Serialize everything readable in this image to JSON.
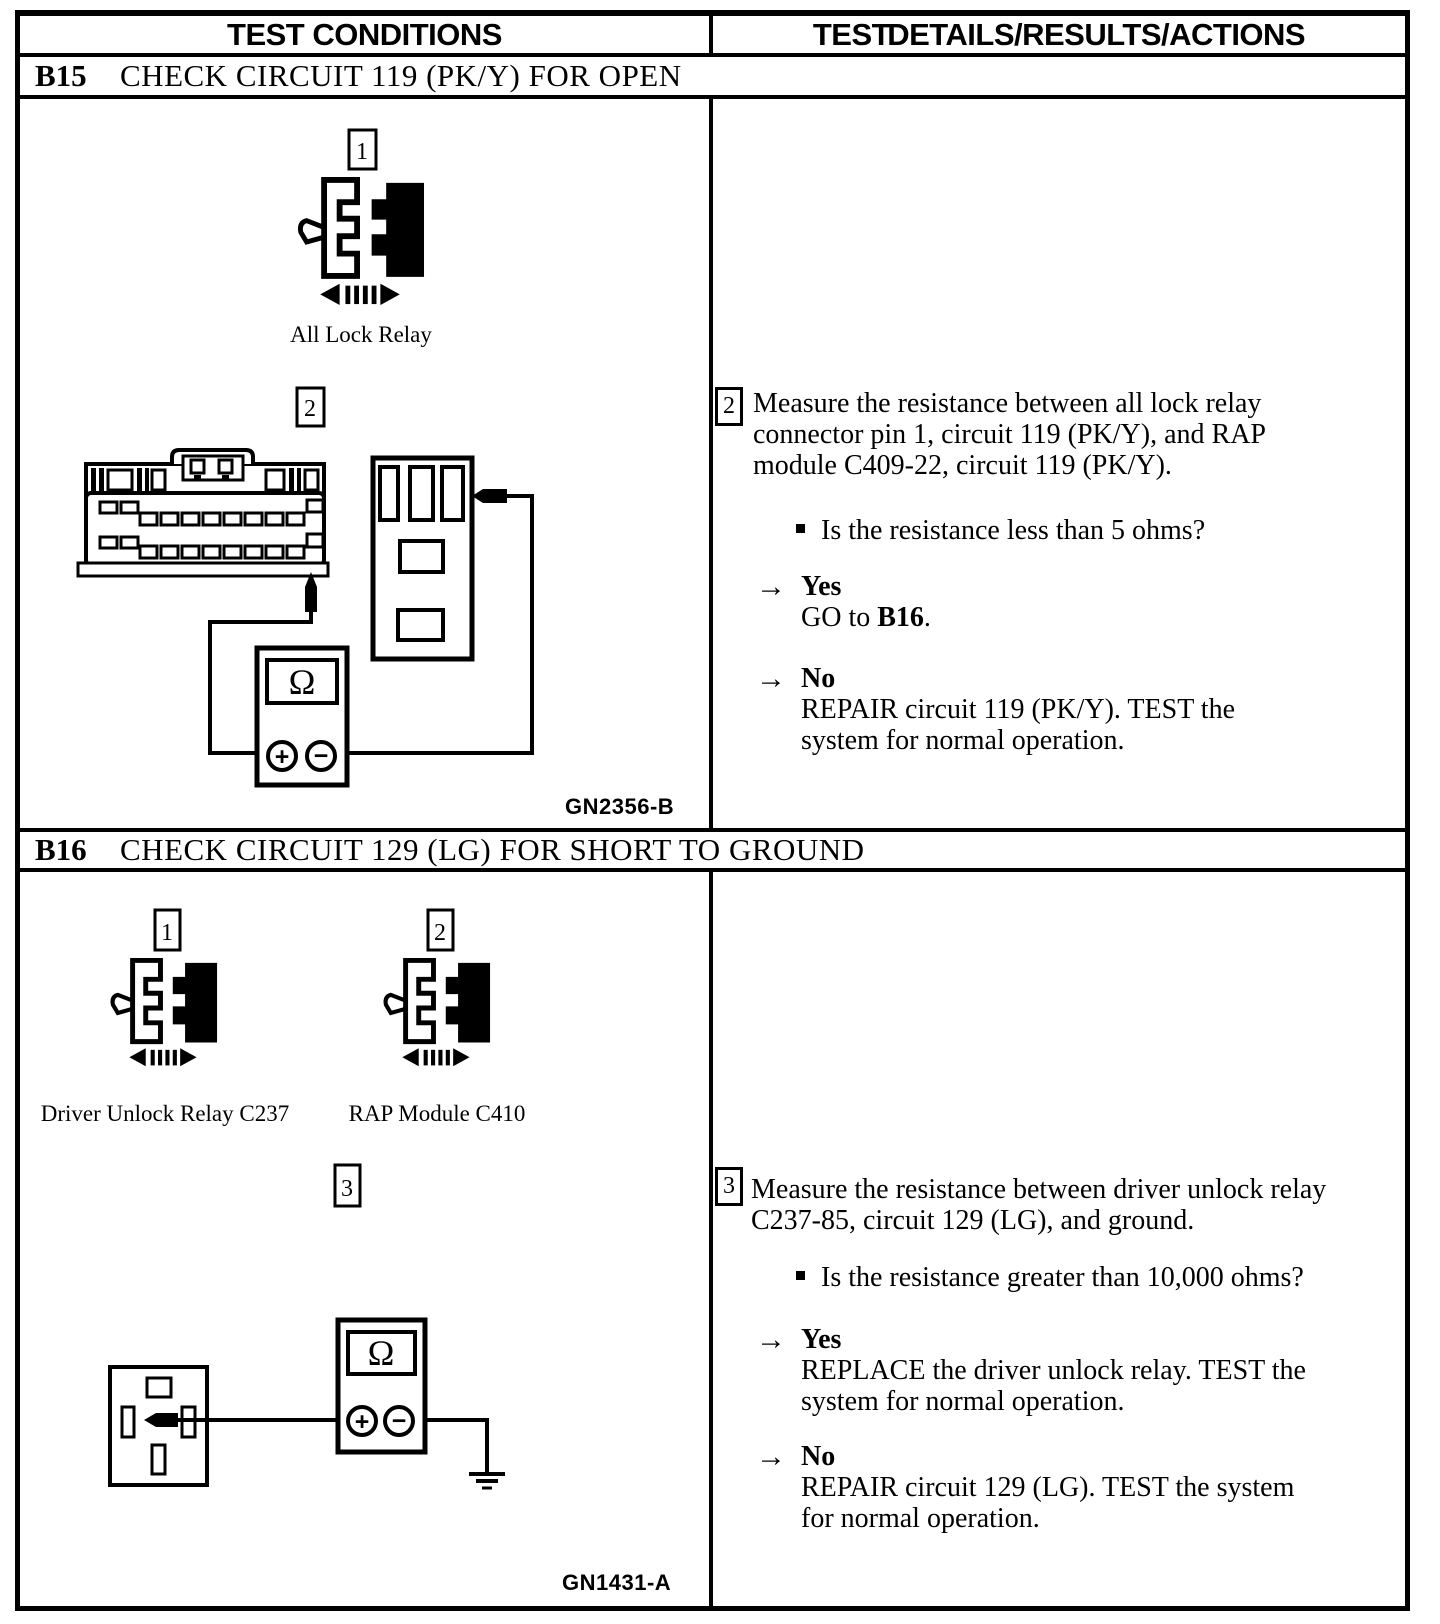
{
  "header": {
    "left_title": "TEST CONDITIONS",
    "right_title": "TEST DETAILS/RESULTS/ACTIONS"
  },
  "b15": {
    "code": "B15",
    "title": "CHECK CIRCUIT 119 (PK/Y) FOR OPEN",
    "diagram": {
      "step1_badge": "1",
      "relay_label": "All Lock Relay",
      "step2_badge": "2",
      "ohm_symbol": "Ω",
      "plus_symbol": "+",
      "minus_symbol": "−",
      "figure_code": "GN2356-B"
    },
    "details": {
      "step_badge": "2",
      "instruction_lines": [
        "Measure the resistance between all lock relay",
        "connector pin 1, circuit 119 (PK/Y), and RAP",
        "module C409-22, circuit 119 (PK/Y)."
      ],
      "question": "Is the resistance less than 5 ohms?",
      "arrow": "→",
      "yes_label": "Yes",
      "yes_action_prefix": "GO to ",
      "yes_action_target": "B16",
      "yes_action_suffix": ".",
      "no_label": "No",
      "no_action_lines": [
        "REPAIR circuit 119 (PK/Y). TEST the",
        "system for normal operation."
      ]
    }
  },
  "b16": {
    "code": "B16",
    "title": "CHECK CIRCUIT 129 (LG) FOR SHORT TO GROUND",
    "diagram": {
      "step1_badge": "1",
      "step2_badge": "2",
      "step3_badge": "3",
      "relay1_label": "Driver Unlock Relay C237",
      "relay2_label": "RAP Module C410",
      "ohm_symbol": "Ω",
      "plus_symbol": "+",
      "minus_symbol": "−",
      "figure_code": "GN1431-A"
    },
    "details": {
      "step_badge": "3",
      "instruction_lines": [
        "Measure the resistance between driver unlock relay",
        "C237-85, circuit 129 (LG), and ground."
      ],
      "question": "Is the resistance greater than 10,000 ohms?",
      "arrow": "→",
      "yes_label": "Yes",
      "yes_action_lines": [
        "REPLACE the driver unlock relay. TEST the",
        "system for normal operation."
      ],
      "no_label": "No",
      "no_action_lines": [
        "REPAIR circuit 129 (LG). TEST the system",
        "for normal operation."
      ]
    }
  }
}
